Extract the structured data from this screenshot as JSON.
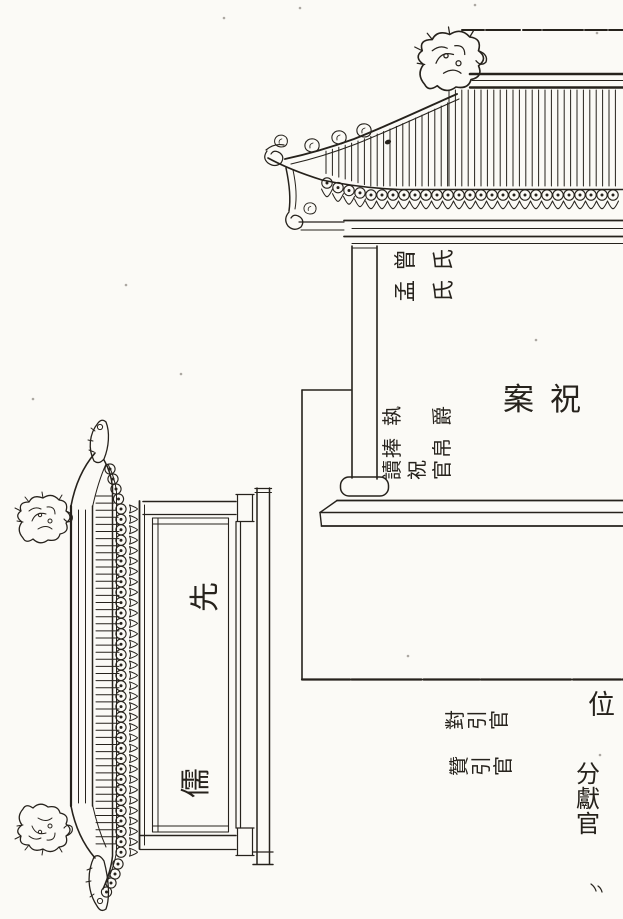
{
  "colors": {
    "paper": "#fbfaf6",
    "ink": "#26221c"
  },
  "labels": {
    "zeng_shi": [
      "曾",
      "氏"
    ],
    "meng_shi": [
      "孟",
      "氏"
    ],
    "zhi_jue": [
      "執",
      "爵"
    ],
    "feng_bo": [
      "捧",
      "帛"
    ],
    "du_zhu_guan": [
      "讀",
      "祝",
      "官"
    ],
    "zhu_an": [
      "案",
      "祝"
    ],
    "wei": "位",
    "dui_yin_guan": [
      "對",
      "引",
      "官"
    ],
    "zan_yin_guan": [
      "贊",
      "引",
      "官"
    ],
    "fen_xian_guan": [
      "分",
      "獻",
      "官"
    ],
    "xian": "先",
    "ru": "儒"
  }
}
